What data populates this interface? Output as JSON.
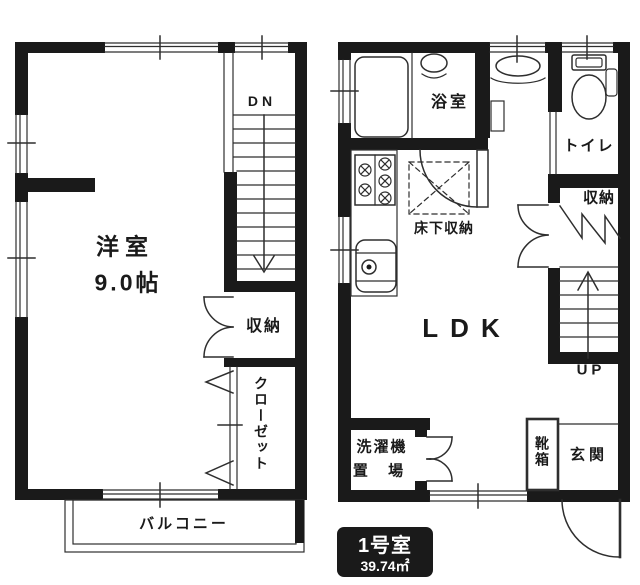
{
  "labels": {
    "bedroom_name": "洋室",
    "bedroom_size": "9.0帖",
    "down": "DN",
    "storage_left": "収納",
    "closet": "クローゼット",
    "balcony": "バルコニー",
    "bath": "浴室",
    "toilet": "トイレ",
    "storage_right": "収納",
    "underfloor_storage": "床下収納",
    "ldk": "LDK",
    "up": "UP",
    "laundry_line1": "洗濯機",
    "laundry_line2": "置 場",
    "shoe_box": "靴箱",
    "entrance": "玄関"
  },
  "unit_badge": {
    "name": "1号室",
    "area": "39.74㎡"
  },
  "colors": {
    "wall": "#1a1a1a",
    "line": "#2e2e2e",
    "badge_bg": "#1a1a1a",
    "badge_text": "#ffffff"
  }
}
